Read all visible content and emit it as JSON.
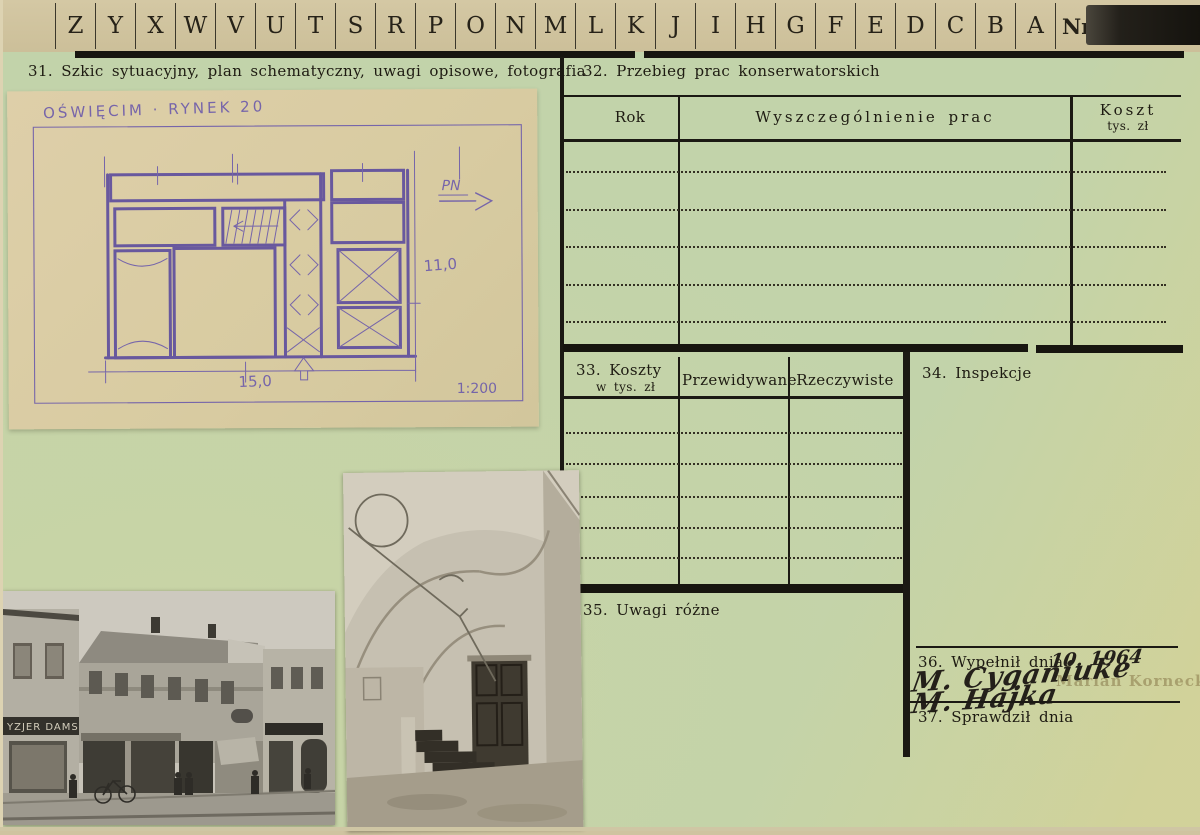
{
  "card": {
    "tabs": {
      "letters": [
        "Z",
        "Y",
        "X",
        "W",
        "V",
        "U",
        "T",
        "S",
        "R",
        "P",
        "O",
        "N",
        "M",
        "L",
        "K",
        "J",
        "I",
        "H",
        "G",
        "F",
        "E",
        "D",
        "C",
        "B",
        "A"
      ],
      "nr": "Nr"
    },
    "s31": {
      "label": "31. Szkic sytuacyjny, plan schematyczny, uwagi opisowe, fotografia"
    },
    "s32": {
      "label": "32. Przebieg prac konserwatorskich",
      "col_rok": "Rok",
      "col_prace": "Wyszczególnienie prac",
      "col_koszt": "Koszt",
      "col_koszt_sub": "tys. zł"
    },
    "s33": {
      "label": "33. Koszty",
      "sub": "w tys. zł",
      "col_przewidywane": "Przewidywane",
      "col_rzeczywiste": "Rzeczywiste"
    },
    "s34": {
      "label": "34. Inspekcje"
    },
    "s35": {
      "label": "35. Uwagi różne"
    },
    "s36": {
      "label": "36. Wypełnił dnia",
      "handwritten_date": "10. 1964",
      "signature_line1": "M. Cyganiuke",
      "signature_line2": "M. Hajka",
      "stamp": "Marian Kornecki"
    },
    "s37": {
      "label": "37. Sprawdził dnia"
    }
  },
  "sketch": {
    "title": "OŚWIĘCIM · RYNEK 20",
    "north": "PN",
    "dim_height": "11,0",
    "dim_width": "15,0",
    "scale": "1:200"
  },
  "photos": {
    "street_sign": "YZJER DAMSKI"
  },
  "colors": {
    "card_green": "#c2d3aa",
    "strip_tan": "#cfc3a0",
    "sketch_paper": "#dccfa6",
    "ink_purple": "#6e5dab",
    "line_black": "#17150f"
  }
}
